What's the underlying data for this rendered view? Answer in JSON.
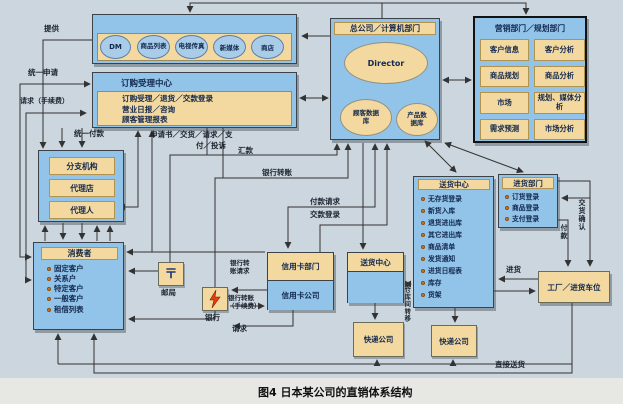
{
  "caption": "图4 日本某公司的直销体系结构",
  "media_box": {
    "channels": [
      "DM",
      "商品列表",
      "电视传真",
      "新媒体",
      "商店"
    ]
  },
  "order_center": {
    "title": "订购受理中心",
    "lines": [
      "订购受理／退货／交款登录",
      "营业日报／咨询",
      "顾客管理报表"
    ]
  },
  "head_office": {
    "title": "总公司／计算机部门",
    "director": "Director",
    "customer_db": "顾客数据\n库",
    "product_db": "产品数\n据库"
  },
  "marketing": {
    "title": "营销部门／规划部门",
    "cells": [
      "客户信息",
      "客户分析",
      "商品规划",
      "商品分析",
      "市场",
      "规划、媒体分析",
      "需求预测",
      "市场分析"
    ]
  },
  "branch": {
    "items": [
      "分支机构",
      "代理店",
      "代理人"
    ]
  },
  "consumer": {
    "title": "消费者",
    "items": [
      "固定客户",
      "关系户",
      "特定客户",
      "一般客户",
      "租借列表"
    ]
  },
  "post_office": {
    "label": "邮局",
    "icon": "〒"
  },
  "bank": {
    "label": "银行"
  },
  "credit": {
    "dept": "信用卡部门",
    "company": "信用卡公司"
  },
  "delivery_sub": {
    "title": "送货中心"
  },
  "express1": {
    "label": "快递公司"
  },
  "express2": {
    "label": "快递公司"
  },
  "delivery_center": {
    "title": "送货中心",
    "items": [
      "无存货登录",
      "新货入库",
      "退货进出库",
      "其它进出库",
      "商品清单",
      "发货通知",
      "进货日程表",
      "库存",
      "货架"
    ]
  },
  "purchase_dept": {
    "title": "进货部门",
    "items": [
      "订货登录",
      "商品登录",
      "支付登录"
    ]
  },
  "factory": {
    "label": "工厂／进货车位"
  },
  "labels": {
    "tigong": "提供",
    "tongyi_shenqing": "统一申请",
    "qingqiu_shouxufei": "请求（手续费）",
    "tongyi_fukuan": "统一付款",
    "shenqing1": "申请书／交货／请求／支",
    "shenqing2": "付／投诉",
    "huikuan": "汇款",
    "yinhang_zhuanzhang": "银行转账",
    "fukuan_qingqiu": "付款请求",
    "jiaokuan_denglu": "交款登录",
    "yz_qingqiu": "银行转\n账请求",
    "yz_shouxufei": "银行转账\n（手续费）",
    "qingqiu": "请求",
    "cangku_zhuanyi": "仓库间转移",
    "fukuan": "付款",
    "jiaohuo_queren": "交货确认",
    "jinhuo": "进货",
    "zhijie_songhuo": "直接送货"
  },
  "colors": {
    "box_blue": "#92c3e9",
    "box_tan": "#f3d9a0",
    "bullet": "#d4791f",
    "wire": "#333333"
  }
}
